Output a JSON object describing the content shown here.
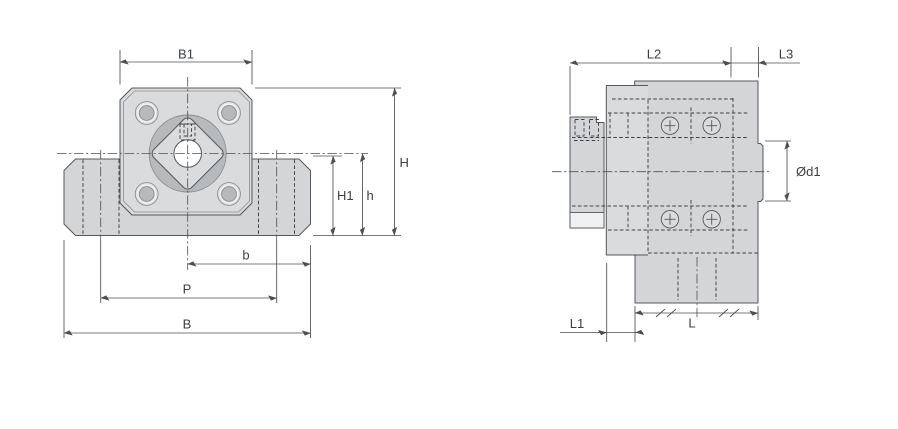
{
  "labels": {
    "B1": "B1",
    "H": "H",
    "H1": "H1",
    "h": "h",
    "b": "b",
    "P": "P",
    "B": "B",
    "L2": "L2",
    "L3": "L3",
    "d1": "Ød1",
    "L1": "L1",
    "L": "L"
  },
  "colors": {
    "background": "#ffffff",
    "part_fill": "#d3d5d7",
    "flange_fill": "#d9dbdc",
    "boss_fill": "#b7babc",
    "bolt_outer_fill": "#e0e2e3",
    "highlight_fill": "#eff0f1",
    "bore_fill": "#ffffff",
    "outline": "#54585b",
    "ring_stroke": "#8b8e91",
    "hidden_line": "#3f4245",
    "center_line": "#4c5054",
    "dimension_line": "#4b4f52",
    "label_text": "#3c4043"
  }
}
